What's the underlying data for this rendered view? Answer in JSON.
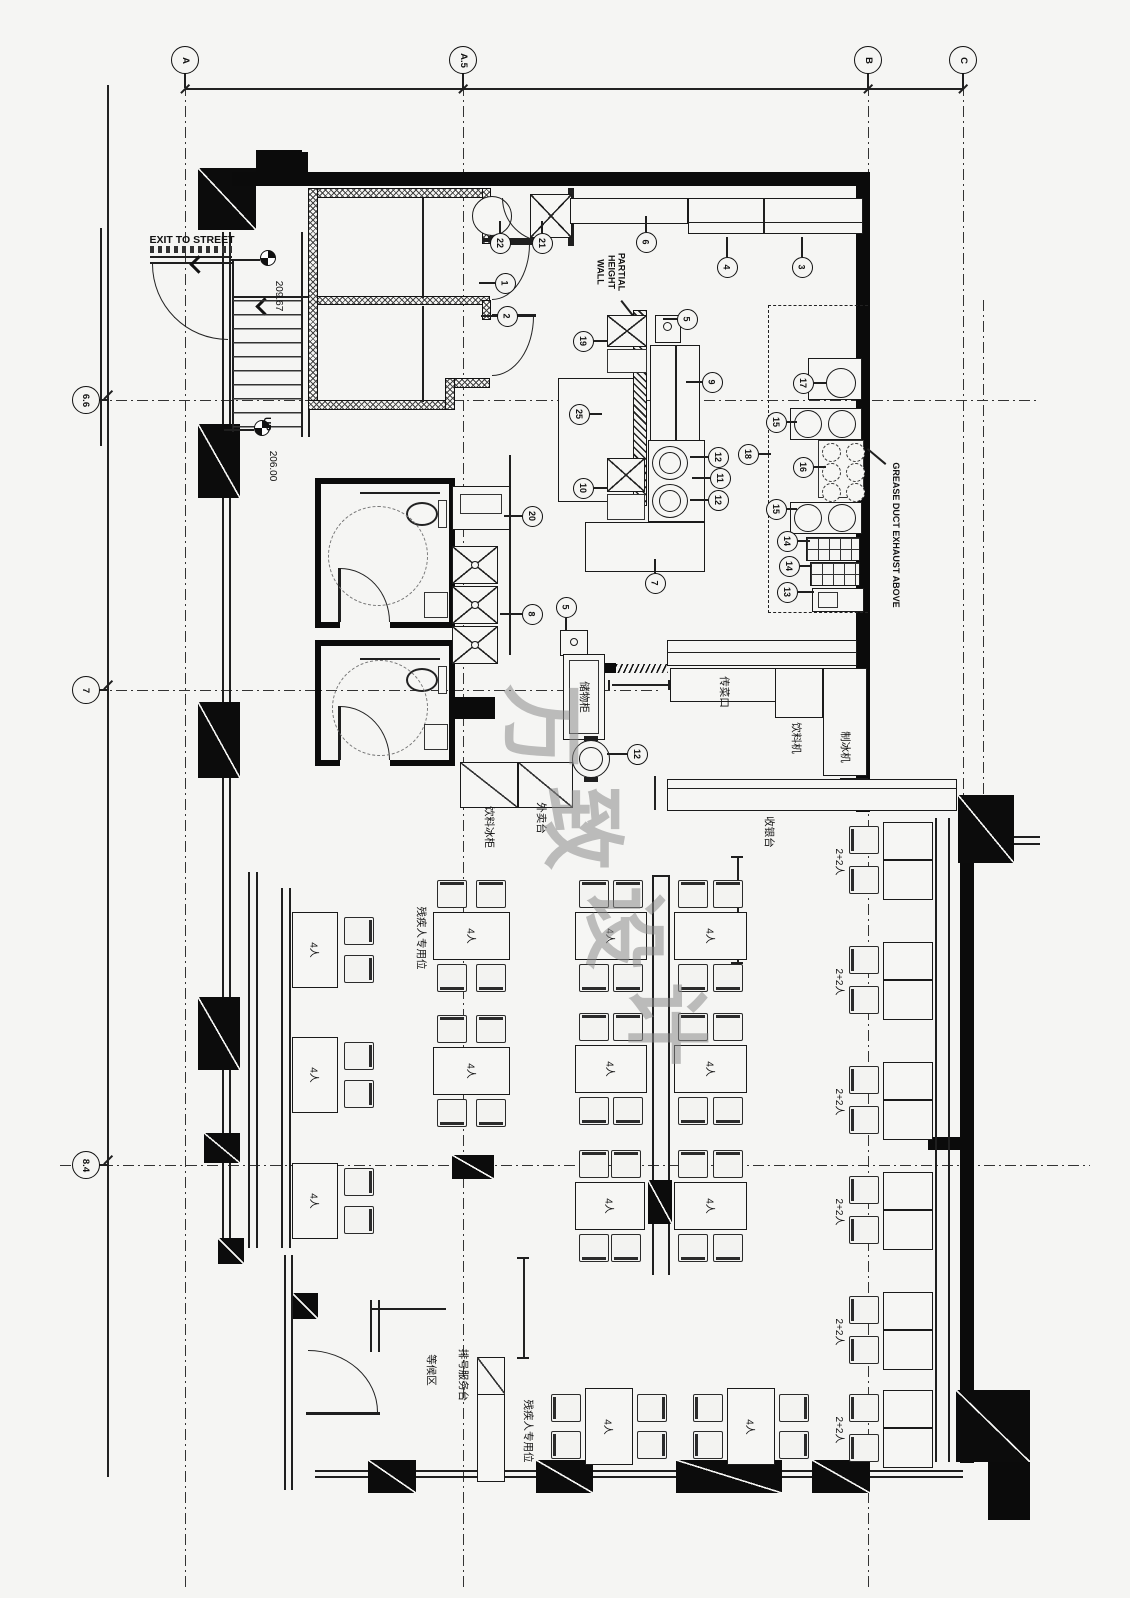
{
  "drawing": {
    "watermark": {
      "text": "万致设计",
      "chars": [
        {
          "ch": "万",
          "x": 548,
          "y": 726
        },
        {
          "ch": "致",
          "x": 588,
          "y": 828
        },
        {
          "ch": "设",
          "x": 630,
          "y": 928
        },
        {
          "ch": "计",
          "x": 672,
          "y": 1024
        }
      ]
    },
    "grid": {
      "top": [
        {
          "label": "A",
          "x": 185
        },
        {
          "label": "A.5",
          "x": 463
        },
        {
          "label": "B",
          "x": 868
        },
        {
          "label": "C",
          "x": 963
        }
      ],
      "left": [
        {
          "label": "6.6",
          "y": 400
        },
        {
          "label": "7",
          "y": 690
        },
        {
          "label": "8.4",
          "y": 1165
        }
      ]
    },
    "annotations": [
      {
        "text": "EXIT TO STREET",
        "x": 192,
        "y": 240,
        "rot": 0,
        "size": 10.5,
        "bold": true
      },
      {
        "text": "209.67",
        "x": 278,
        "y": 296,
        "rot": 90,
        "size": 10,
        "bold": false
      },
      {
        "text": "UP",
        "x": 266,
        "y": 424,
        "rot": 90,
        "size": 10,
        "bold": true
      },
      {
        "text": "206.00",
        "x": 272,
        "y": 466,
        "rot": 90,
        "size": 10,
        "bold": false
      },
      {
        "text": "PARTIAL\nHEIGHT\nWALL",
        "x": 611,
        "y": 272,
        "rot": 90,
        "size": 9,
        "bold": true
      },
      {
        "text": "GREASE DUCT EXHAUST ABOVE",
        "x": 896,
        "y": 535,
        "rot": 90,
        "size": 9,
        "bold": true
      }
    ],
    "room_labels": [
      {
        "text": "储物柜",
        "x": 584,
        "y": 697
      },
      {
        "text": "传菜口",
        "x": 724,
        "y": 692
      },
      {
        "text": "饮料机",
        "x": 796,
        "y": 738
      },
      {
        "text": "制冰机",
        "x": 845,
        "y": 747
      },
      {
        "text": "收银台",
        "x": 769,
        "y": 832
      },
      {
        "text": "外卖台",
        "x": 541,
        "y": 818
      },
      {
        "text": "饮料冰柜",
        "x": 489,
        "y": 827
      },
      {
        "text": "残疾人专用位",
        "x": 421,
        "y": 938
      },
      {
        "text": "残疾人专用位",
        "x": 528,
        "y": 1431
      },
      {
        "text": "排号服务台",
        "x": 463,
        "y": 1375
      },
      {
        "text": "等候区",
        "x": 431,
        "y": 1370
      }
    ],
    "seat_label_four": "4人",
    "seat_label_two_two": "2+2人",
    "tables": [
      {
        "label": "4人",
        "x": 292,
        "y": 912,
        "w": 46,
        "h": 76,
        "c": "r2"
      },
      {
        "label": "4人",
        "x": 292,
        "y": 1037,
        "w": 46,
        "h": 76,
        "c": "r2"
      },
      {
        "label": "4人",
        "x": 292,
        "y": 1163,
        "w": 46,
        "h": 76,
        "c": "r2"
      },
      {
        "label": "4人",
        "x": 433,
        "y": 912,
        "w": 77,
        "h": 48,
        "c": "tb"
      },
      {
        "label": "4人",
        "x": 433,
        "y": 1047,
        "w": 77,
        "h": 48,
        "c": "tb"
      },
      {
        "label": "4人",
        "x": 575,
        "y": 912,
        "w": 72,
        "h": 48,
        "c": "tb"
      },
      {
        "label": "4人",
        "x": 575,
        "y": 1045,
        "w": 72,
        "h": 48,
        "c": "tb"
      },
      {
        "label": "4人",
        "x": 575,
        "y": 1182,
        "w": 70,
        "h": 48,
        "c": "tb"
      },
      {
        "label": "4人",
        "x": 674,
        "y": 912,
        "w": 73,
        "h": 48,
        "c": "tb"
      },
      {
        "label": "4人",
        "x": 674,
        "y": 1045,
        "w": 73,
        "h": 48,
        "c": "tb"
      },
      {
        "label": "4人",
        "x": 674,
        "y": 1182,
        "w": 73,
        "h": 48,
        "c": "tb"
      },
      {
        "label": "4人",
        "x": 585,
        "y": 1388,
        "w": 48,
        "h": 77,
        "c": "lr"
      },
      {
        "label": "4人",
        "x": 727,
        "y": 1388,
        "w": 48,
        "h": 77,
        "c": "lr"
      }
    ],
    "booths": [
      {
        "label": "2+2人",
        "y": 822
      },
      {
        "label": "2+2人",
        "y": 942
      },
      {
        "label": "2+2人",
        "y": 1062
      },
      {
        "label": "2+2人",
        "y": 1172
      },
      {
        "label": "2+2人",
        "y": 1292
      },
      {
        "label": "2+2人",
        "y": 1390
      }
    ],
    "callouts": [
      {
        "n": "22",
        "x": 500,
        "y": 243,
        "l": "u",
        "len": 12
      },
      {
        "n": "21",
        "x": 542,
        "y": 243,
        "l": "u",
        "len": 12
      },
      {
        "n": "1",
        "x": 505,
        "y": 283,
        "l": "l",
        "len": 16
      },
      {
        "n": "2",
        "x": 507,
        "y": 316,
        "l": "l",
        "len": 16
      },
      {
        "n": "6",
        "x": 646,
        "y": 242,
        "l": "u",
        "len": 16
      },
      {
        "n": "4",
        "x": 727,
        "y": 267,
        "l": "u",
        "len": 20
      },
      {
        "n": "3",
        "x": 802,
        "y": 267,
        "l": "u",
        "len": 20
      },
      {
        "n": "19",
        "x": 583,
        "y": 341,
        "l": "r",
        "len": 14
      },
      {
        "n": "5",
        "x": 687,
        "y": 319,
        "l": "l",
        "len": 14
      },
      {
        "n": "9",
        "x": 712,
        "y": 382,
        "l": "l",
        "len": 16
      },
      {
        "n": "25",
        "x": 579,
        "y": 414,
        "l": "r",
        "len": 12
      },
      {
        "n": "10",
        "x": 583,
        "y": 488,
        "l": "r",
        "len": 14
      },
      {
        "n": "12",
        "x": 718,
        "y": 457,
        "l": "l",
        "len": 18
      },
      {
        "n": "11",
        "x": 720,
        "y": 478,
        "l": "l",
        "len": 18
      },
      {
        "n": "12",
        "x": 718,
        "y": 500,
        "l": "l",
        "len": 18
      },
      {
        "n": "18",
        "x": 748,
        "y": 454,
        "l": "r",
        "len": 12
      },
      {
        "n": "17",
        "x": 803,
        "y": 383,
        "l": "r",
        "len": 12
      },
      {
        "n": "15",
        "x": 776,
        "y": 422,
        "l": "r",
        "len": 10
      },
      {
        "n": "16",
        "x": 803,
        "y": 467,
        "l": "r",
        "len": 12
      },
      {
        "n": "15",
        "x": 776,
        "y": 509,
        "l": "r",
        "len": 10
      },
      {
        "n": "14",
        "x": 787,
        "y": 541,
        "l": "r",
        "len": 12
      },
      {
        "n": "14",
        "x": 789,
        "y": 566,
        "l": "r",
        "len": 12
      },
      {
        "n": "13",
        "x": 787,
        "y": 592,
        "l": "r",
        "len": 16
      },
      {
        "n": "20",
        "x": 532,
        "y": 516,
        "l": "l",
        "len": 18
      },
      {
        "n": "8",
        "x": 532,
        "y": 614,
        "l": "l",
        "len": 22
      },
      {
        "n": "5",
        "x": 566,
        "y": 607,
        "l": "d",
        "len": 12
      },
      {
        "n": "12",
        "x": 637,
        "y": 754,
        "l": "l",
        "len": 20
      },
      {
        "n": "7",
        "x": 655,
        "y": 583,
        "l": "u",
        "len": 14
      }
    ]
  }
}
